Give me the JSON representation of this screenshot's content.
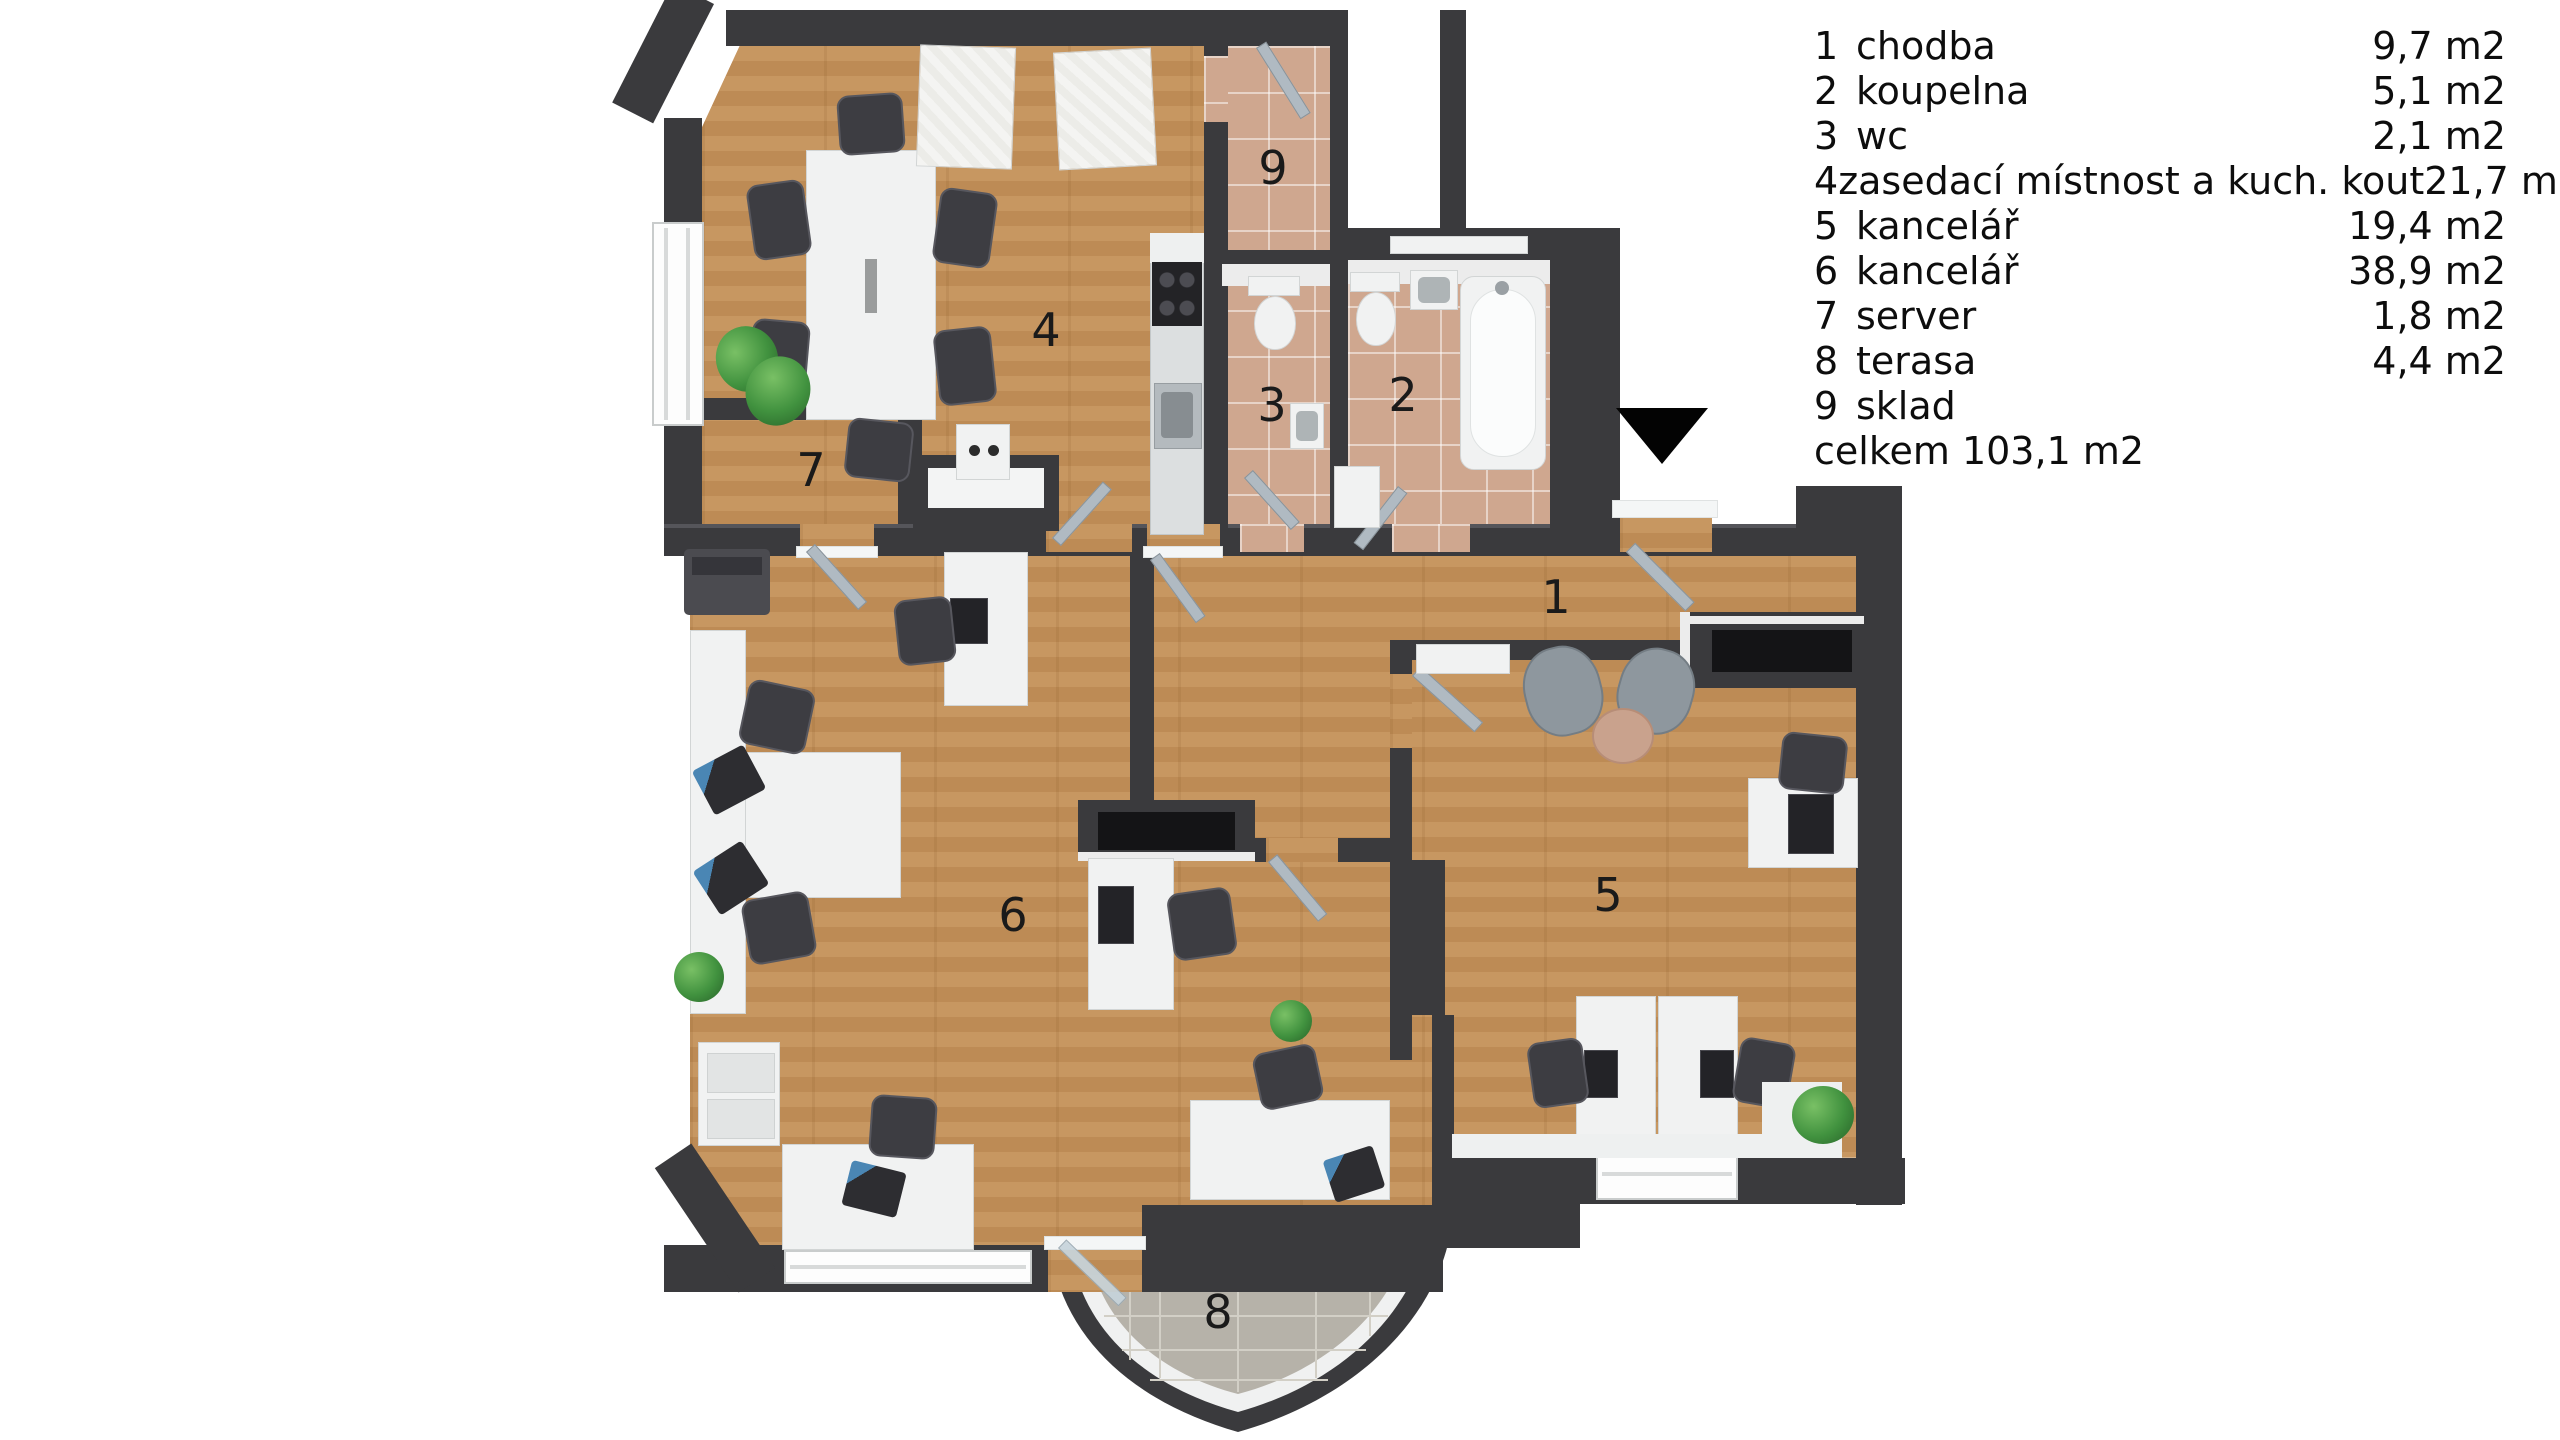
{
  "legend": {
    "rows": [
      {
        "num": "1",
        "name": "chodba",
        "area": "9,7 m2"
      },
      {
        "num": "2",
        "name": "koupelna",
        "area": "5,1 m2"
      },
      {
        "num": "3",
        "name": "wc",
        "area": "2,1 m2"
      },
      {
        "num": "4",
        "name": "zasedací místnost a kuch. kout",
        "area": "21,7 m2"
      },
      {
        "num": "5",
        "name": "kancelář",
        "area": "19,4 m2"
      },
      {
        "num": "6",
        "name": "kancelář",
        "area": "38,9 m2"
      },
      {
        "num": "7",
        "name": "server",
        "area": "1,8 m2"
      },
      {
        "num": "8",
        "name": "terasa",
        "area": "4,4 m2"
      },
      {
        "num": "9",
        "name": "sklad",
        "area": ""
      }
    ],
    "total": "celkem 103,1 m2"
  },
  "marker": {
    "icon": "entrance-triangle-down",
    "color": "#030303"
  },
  "colors": {
    "wall": "#3a3a3d",
    "wood_floor": "#c49260",
    "bathroom_tile": "#cfa78f",
    "terrace_tile": "#b6b2a9",
    "furniture_white": "#f1f2f2",
    "chair_dark": "#3d3d42",
    "door_gray": "#b0bac2",
    "plant_green": "#41923f"
  }
}
